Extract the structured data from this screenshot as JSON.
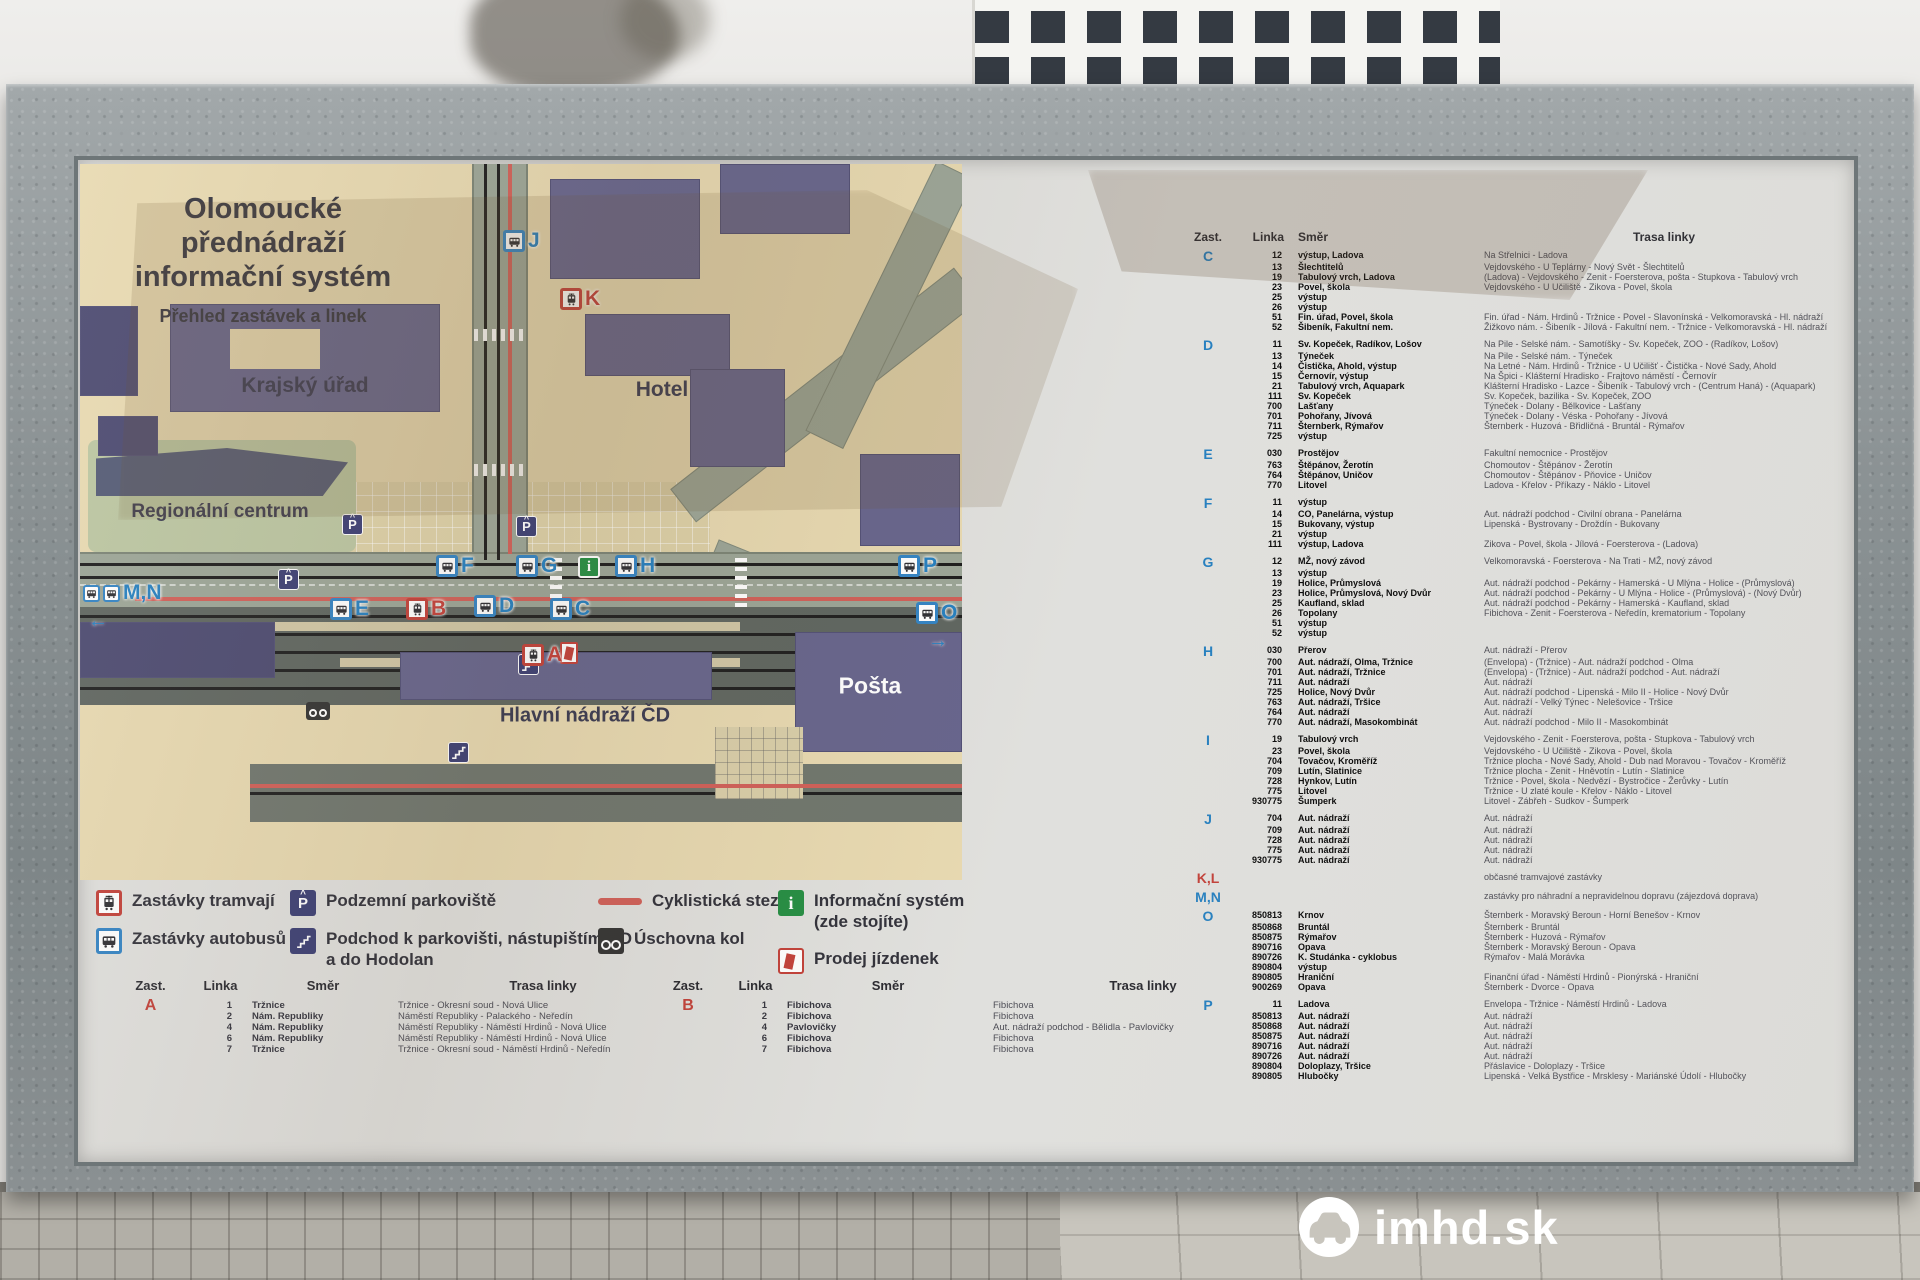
{
  "watermark": {
    "text": "imhd.sk"
  },
  "board": {
    "title1": "Olomoucké přednádraží",
    "title2": "informační systém",
    "subtitle": "Přehled zastávek a linek",
    "map": {
      "labels": {
        "krajsky_urad": "Krajský úřad",
        "hotel": "Hotel",
        "regionalni_centrum": "Regionální centrum",
        "hlavni_nadrazi": "Hlavní nádraží ČD",
        "posta": "Pošta"
      },
      "parking_letter": "P",
      "info_letter": "i",
      "stops": [
        {
          "letter": "J",
          "kind": "bus",
          "x": 423,
          "y": 66
        },
        {
          "letter": "K",
          "kind": "tram",
          "x": 480,
          "y": 124
        },
        {
          "letter": "M,N",
          "kind": "bus2",
          "x": 3,
          "y": 418,
          "arrow": "←",
          "ax": 8,
          "ay": 446
        },
        {
          "letter": "F",
          "kind": "bus",
          "x": 356,
          "y": 391
        },
        {
          "letter": "G",
          "kind": "bus",
          "x": 436,
          "y": 391
        },
        {
          "letter": "H",
          "kind": "bus",
          "x": 535,
          "y": 391
        },
        {
          "letter": "E",
          "kind": "bus",
          "x": 250,
          "y": 434
        },
        {
          "letter": "B",
          "kind": "tram",
          "x": 326,
          "y": 434
        },
        {
          "letter": "D",
          "kind": "bus",
          "x": 394,
          "y": 431
        },
        {
          "letter": "C",
          "kind": "bus",
          "x": 470,
          "y": 434
        },
        {
          "letter": "A",
          "kind": "tram",
          "x": 442,
          "y": 480
        },
        {
          "letter": "P",
          "kind": "bus",
          "x": 818,
          "y": 391
        },
        {
          "letter": "O",
          "kind": "bus",
          "x": 836,
          "y": 438,
          "arrow": "→",
          "ax": 848,
          "ay": 466
        }
      ]
    },
    "legend": [
      {
        "icon": "tram-stop-icon",
        "label": "Zastávky tramvají"
      },
      {
        "icon": "bus-stop-icon",
        "label": "Zastávky autobusů"
      },
      {
        "icon": "underground-parking-icon",
        "label": "Podzemní parkoviště"
      },
      {
        "icon": "underpass-icon",
        "label": "Podchod k parkovišti, nástupištím ČD\na do Hodolan"
      },
      {
        "icon": "cycle-path-icon",
        "label": "Cyklistická stezka"
      },
      {
        "icon": "bike-storage-icon",
        "label": "Úschovna kol"
      },
      {
        "icon": "info-system-icon",
        "label": "Informační systém\n(zde stojíte)"
      },
      {
        "icon": "ticket-sales-icon",
        "label": "Prodej jízdenek"
      }
    ],
    "headers": {
      "zast": "Zast.",
      "linka": "Linka",
      "smer": "Směr",
      "trasa": "Trasa linky"
    },
    "stop_tables": [
      {
        "letter": "A",
        "color": "red",
        "rows": [
          [
            "1",
            "Tržnice",
            "Tržnice - Okresní soud - Nová Ulice"
          ],
          [
            "2",
            "Nám. Republiky",
            "Náměstí Republiky - Palackého - Neředín"
          ],
          [
            "4",
            "Nám. Republiky",
            "Náměstí Republiky - Náměstí Hrdinů - Nová Ulice"
          ],
          [
            "6",
            "Nám. Republiky",
            "Náměstí Republiky - Náměstí Hrdinů - Nová Ulice"
          ],
          [
            "7",
            "Tržnice",
            "Tržnice - Okresní soud - Náměstí Hrdinů - Neředín"
          ]
        ]
      },
      {
        "letter": "B",
        "color": "red",
        "rows": [
          [
            "1",
            "Fibichova",
            "Fibichova"
          ],
          [
            "2",
            "Fibichova",
            "Fibichova"
          ],
          [
            "4",
            "Pavlovičky",
            "Aut. nádraží podchod - Bělidla - Pavlovičky"
          ],
          [
            "6",
            "Fibichova",
            "Fibichova"
          ],
          [
            "7",
            "Fibichova",
            "Fibichova"
          ]
        ]
      }
    ],
    "right_table": {
      "sections": [
        {
          "stop": "C",
          "color": "blue",
          "rows": [
            [
              "12",
              "výstup, Ladova",
              "Na Střelnici - Ladova"
            ],
            [
              "13",
              "Šlechtitelů",
              "Vejdovského - U Teplárny - Nový Svět - Šlechtitelů"
            ],
            [
              "19",
              "Tabulový vrch, Ladova",
              "(Ladova) - Vejdovského - Zenit - Foersterova, pošta - Stupkova - Tabulový vrch"
            ],
            [
              "23",
              "Povel, škola",
              "Vejdovského - U Učiliště - Zikova - Povel, škola"
            ],
            [
              "25",
              "výstup",
              ""
            ],
            [
              "26",
              "výstup",
              ""
            ],
            [
              "51",
              "Fin. úřad, Povel, škola",
              "Fin. úřad - Nám. Hrdinů - Tržnice - Povel - Slavonínská - Velkomoravská - Hl. nádraží"
            ],
            [
              "52",
              "Šibeník, Fakultní nem.",
              "Žižkovo nám. - Šibeník - Jílová - Fakultní nem. - Tržnice - Velkomoravská - Hl. nádraží"
            ]
          ]
        },
        {
          "stop": "D",
          "color": "blue",
          "rows": [
            [
              "11",
              "Sv. Kopeček, Radíkov, Lošov",
              "Na Pile - Selské nám. - Samotíšky - Sv. Kopeček, ZOO - (Radíkov, Lošov)"
            ],
            [
              "13",
              "Týneček",
              "Na Pile - Selské nám. - Týneček"
            ],
            [
              "14",
              "Čistička, Ahold, výstup",
              "Na Letné - Nám. Hrdinů - Tržnice - U Učilišť - Čistička - Nové Sady, Ahold"
            ],
            [
              "15",
              "Černovír, výstup",
              "Na Špici - Klášterní Hradisko - Frajtovo náměstí - Černovír"
            ],
            [
              "21",
              "Tabulový vrch, Aquapark",
              "Klášterní Hradisko - Lazce - Šibeník - Tabulový vrch - (Centrum Haná) - (Aquapark)"
            ],
            [
              "111",
              "Sv. Kopeček",
              "Sv. Kopeček, bazilika - Sv. Kopeček, ZOO"
            ],
            [
              "700",
              "Lašťany",
              "Týneček - Dolany - Bělkovice - Lašťany"
            ],
            [
              "701",
              "Pohořany, Jívová",
              "Týneček - Dolany - Véska - Pohořany - Jívová"
            ],
            [
              "711",
              "Šternberk, Rýmařov",
              "Šternberk - Huzová - Břidličná - Bruntál - Rýmařov"
            ],
            [
              "725",
              "výstup",
              ""
            ]
          ]
        },
        {
          "stop": "E",
          "color": "blue",
          "rows": [
            [
              "030",
              "Prostějov",
              "Fakultní nemocnice - Prostějov"
            ],
            [
              "763",
              "Štěpánov, Žerotín",
              "Chomoutov - Štěpánov - Žerotín"
            ],
            [
              "764",
              "Štěpánov, Uničov",
              "Chomoutov - Štěpánov - Pňovice - Uničov"
            ],
            [
              "770",
              "Litovel",
              "Ladova - Křelov - Příkazy - Náklo - Litovel"
            ]
          ]
        },
        {
          "stop": "F",
          "color": "blue",
          "rows": [
            [
              "11",
              "výstup",
              ""
            ],
            [
              "14",
              "CO, Panelárna, výstup",
              "Aut. nádraží podchod - Civilní obrana - Panelárna"
            ],
            [
              "15",
              "Bukovany, výstup",
              "Lipenská - Bystrovany - Droždín - Bukovany"
            ],
            [
              "21",
              "výstup",
              ""
            ],
            [
              "111",
              "výstup, Ladova",
              "Zikova - Povel, škola - Jílová - Foersterova - (Ladova)"
            ]
          ]
        },
        {
          "stop": "G",
          "color": "blue",
          "rows": [
            [
              "12",
              "MŽ, nový závod",
              "Velkomoravská - Foersterova - Na Trati - MŽ, nový závod"
            ],
            [
              "13",
              "výstup",
              ""
            ],
            [
              "19",
              "Holice, Průmyslová",
              "Aut. nádraží podchod - Pekárny - Hamerská - U Mlýna - Holice - (Průmyslová)"
            ],
            [
              "23",
              "Holice, Průmyslová, Nový Dvůr",
              "Aut. nádraží podchod - Pekárny - U Mlýna - Holice - (Průmyslová) - (Nový Dvůr)"
            ],
            [
              "25",
              "Kaufland, sklad",
              "Aut. nádraží podchod - Pekárny - Hamerská - Kaufland, sklad"
            ],
            [
              "26",
              "Topolany",
              "Fibichova - Zenit - Foersterova - Neředín, krematorium - Topolany"
            ],
            [
              "51",
              "výstup",
              ""
            ],
            [
              "52",
              "výstup",
              ""
            ]
          ]
        },
        {
          "stop": "H",
          "color": "blue",
          "rows": [
            [
              "030",
              "Přerov",
              "Aut. nádraží - Přerov"
            ],
            [
              "700",
              "Aut. nádraží, Olma, Tržnice",
              "(Envelopa) - (Tržnice) - Aut. nádraží podchod - Olma"
            ],
            [
              "701",
              "Aut. nádraží, Tržnice",
              "(Envelopa) - (Tržnice) - Aut. nádraží podchod - Aut. nádraží"
            ],
            [
              "711",
              "Aut. nádraží",
              "Aut. nádraží"
            ],
            [
              "725",
              "Holice, Nový Dvůr",
              "Aut. nádraží podchod - Lipenská - Milo II - Holice - Nový Dvůr"
            ],
            [
              "763",
              "Aut. nádraží, Tršice",
              "Aut. nádraží - Velký Týnec - Nelešovice - Tršice"
            ],
            [
              "764",
              "Aut. nádraží",
              "Aut. nádraží"
            ],
            [
              "770",
              "Aut. nádraží, Masokombinát",
              "Aut. nádraží podchod - Milo II - Masokombinát"
            ]
          ]
        },
        {
          "stop": "I",
          "color": "blue",
          "rows": [
            [
              "19",
              "Tabulový vrch",
              "Vejdovského - Zenit - Foersterova, pošta - Stupkova - Tabulový vrch"
            ],
            [
              "23",
              "Povel, škola",
              "Vejdovského - U Učiliště - Zikova - Povel, škola"
            ],
            [
              "704",
              "Tovačov, Kroměříž",
              "Tržnice plocha - Nové Sady, Ahold - Dub nad Moravou - Tovačov - Kroměříž"
            ],
            [
              "709",
              "Lutín, Slatinice",
              "Tržnice plocha - Zenit - Hněvotín - Lutín - Slatinice"
            ],
            [
              "728",
              "Hynkov, Lutín",
              "Tržnice - Povel, škola - Nedvězí - Bystročice - Žerůvky - Lutín"
            ],
            [
              "775",
              "Litovel",
              "Tržnice - U zlaté koule - Křelov - Náklo - Litovel"
            ],
            [
              "930775",
              "Šumperk",
              "Litovel - Zábřeh - Sudkov - Šumperk"
            ]
          ]
        },
        {
          "stop": "J",
          "color": "blue",
          "rows": [
            [
              "704",
              "Aut. nádraží",
              "Aut. nádraží"
            ],
            [
              "709",
              "Aut. nádraží",
              "Aut. nádraží"
            ],
            [
              "728",
              "Aut. nádraží",
              "Aut. nádraží"
            ],
            [
              "775",
              "Aut. nádraží",
              "Aut. nádraží"
            ],
            [
              "930775",
              "Aut. nádraží",
              "Aut. nádraží"
            ]
          ]
        },
        {
          "stop": "K,L",
          "color": "red",
          "rows": [
            [
              "",
              "",
              "občasné tramvajové zastávky"
            ]
          ]
        },
        {
          "stop": "M,N",
          "color": "blue",
          "rows": [
            [
              "",
              "",
              "zastávky pro náhradní a nepravidelnou dopravu (zájezdová doprava)"
            ]
          ]
        },
        {
          "stop": "O",
          "color": "blue",
          "rows": [
            [
              "850813",
              "Krnov",
              "Šternberk - Moravský Beroun - Horní Benešov - Krnov"
            ],
            [
              "850868",
              "Bruntál",
              "Šternberk - Bruntál"
            ],
            [
              "850875",
              "Rýmařov",
              "Šternberk - Huzová - Rýmařov"
            ],
            [
              "890716",
              "Opava",
              "Šternberk - Moravský Beroun - Opava"
            ],
            [
              "890726",
              "K. Studánka - cyklobus",
              "Rýmařov - Malá Morávka"
            ],
            [
              "890804",
              "výstup",
              ""
            ],
            [
              "890805",
              "Hraniční",
              "Finanční úřad - Náměstí Hrdinů - Pionýrská - Hraniční"
            ],
            [
              "900269",
              "Opava",
              "Šternberk - Dvorce - Opava"
            ]
          ]
        },
        {
          "stop": "P",
          "color": "blue",
          "rows": [
            [
              "11",
              "Ladova",
              "Envelopa - Tržnice - Náměstí Hrdinů - Ladova"
            ],
            [
              "850813",
              "Aut. nádraží",
              "Aut. nádraží"
            ],
            [
              "850868",
              "Aut. nádraží",
              "Aut. nádraží"
            ],
            [
              "850875",
              "Aut. nádraží",
              "Aut. nádraží"
            ],
            [
              "890716",
              "Aut. nádraží",
              "Aut. nádraží"
            ],
            [
              "890726",
              "Aut. nádraží",
              "Aut. nádraží"
            ],
            [
              "890804",
              "Doloplazy, Tršice",
              "Přáslavice - Doloplazy - Tršice"
            ],
            [
              "890805",
              "Hlubočky",
              "Lipenská - Velká Bystřice - Mrsklesy - Mariánské Údolí - Hlubočky"
            ]
          ]
        }
      ]
    }
  }
}
